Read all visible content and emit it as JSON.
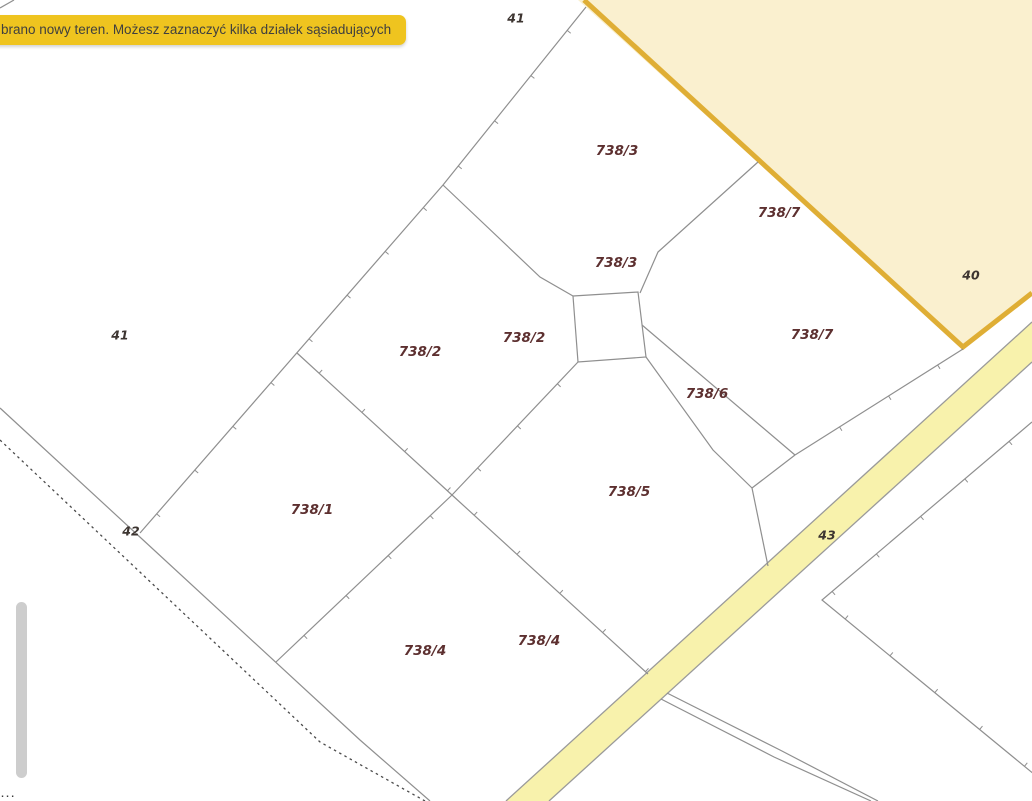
{
  "banner": {
    "text": "brano nowy teren. Możesz zaznaczyć kilka działek sąsiadujących",
    "bg": "#efc41f",
    "text_color": "#3f3f3f"
  },
  "map": {
    "background": "#ffffff",
    "line_color": "#8f8f8f",
    "parcel_label_color": "#5d3030",
    "area_label_color": "#3d3531",
    "selected_region": {
      "label": "40",
      "fill": "#faf0cf",
      "border_color": "#dfae35",
      "fill_points": "578,0 1032,0 1032,293 963,347",
      "border_points": "584,0 963,347 1032,293"
    },
    "road": {
      "label": "43",
      "fill": "#f8f2ac",
      "border_color": "#9a9a9a",
      "fill_points": "1032,322 1032,362 549,801 506,801",
      "border1": "1032,322 506,801",
      "border2": "1032,362 549,801"
    },
    "lines": [
      {
        "name": "boundary-long-diagonal",
        "points": "586,7 443,185 140,533",
        "ticks": true
      },
      {
        "name": "boundary-branch-to-square",
        "points": "443,185 540,277 573,296"
      },
      {
        "name": "parcel-square",
        "points": "573,296 638,292 646,357 578,362 573,296"
      },
      {
        "name": "boundary-738-3-738-7",
        "points": "758,162 658,252 640,293"
      },
      {
        "name": "boundary-crossing-a",
        "points": "297,353 452,495 648,674",
        "ticks": true
      },
      {
        "name": "boundary-crossing-b",
        "points": "578,362 452,495 276,662",
        "ticks": true
      },
      {
        "name": "boundary-738-6-nw",
        "points": "642,325 795,455"
      },
      {
        "name": "boundary-738-6-se",
        "points": "646,357 713,450 752,488"
      },
      {
        "name": "boundary-738-6-cap",
        "points": "795,455 752,488"
      },
      {
        "name": "boundary-frontage",
        "points": "963,349 795,455",
        "ticks": true
      },
      {
        "name": "boundary-stem",
        "points": "752,488 768,566"
      },
      {
        "name": "boundary-42-solid",
        "points": "0,408 360,740 430,801"
      },
      {
        "name": "boundary-42-dashed",
        "points": "0,440 320,742 425,801",
        "dash": "2.5 3.5",
        "color": "#4a4a4a",
        "width": 1.3
      },
      {
        "name": "boundary-tick-v",
        "points": "1032,422 822,600 1035,775",
        "ticks": true
      },
      {
        "name": "path-double-1",
        "points": "667,693 780,750 878,801"
      },
      {
        "name": "path-double-2",
        "points": "661,699 774,757 871,801"
      },
      {
        "name": "edge-fragment-line",
        "points": "0,8 14,0"
      }
    ],
    "labels": {
      "parcels": [
        {
          "text": "738/3",
          "x": 617,
          "y": 151
        },
        {
          "text": "738/3",
          "x": 616,
          "y": 263
        },
        {
          "text": "738/7",
          "x": 779,
          "y": 213
        },
        {
          "text": "738/7",
          "x": 812,
          "y": 335
        },
        {
          "text": "738/2",
          "x": 420,
          "y": 352
        },
        {
          "text": "738/2",
          "x": 524,
          "y": 338
        },
        {
          "text": "738/1",
          "x": 312,
          "y": 510
        },
        {
          "text": "738/5",
          "x": 629,
          "y": 492
        },
        {
          "text": "738/6",
          "x": 707,
          "y": 394
        },
        {
          "text": "738/4",
          "x": 425,
          "y": 651
        },
        {
          "text": "738/4",
          "x": 539,
          "y": 641
        }
      ],
      "areas": [
        {
          "text": "41",
          "x": 516,
          "y": 19
        },
        {
          "text": "41",
          "x": 120,
          "y": 336
        },
        {
          "text": "40",
          "x": 971,
          "y": 276
        },
        {
          "text": "42",
          "x": 131,
          "y": 532
        },
        {
          "text": "43",
          "x": 827,
          "y": 536
        }
      ]
    }
  },
  "scrollbar": {
    "x": 16,
    "y": 602,
    "w": 11,
    "h": 176
  },
  "edge_fragment": "···"
}
